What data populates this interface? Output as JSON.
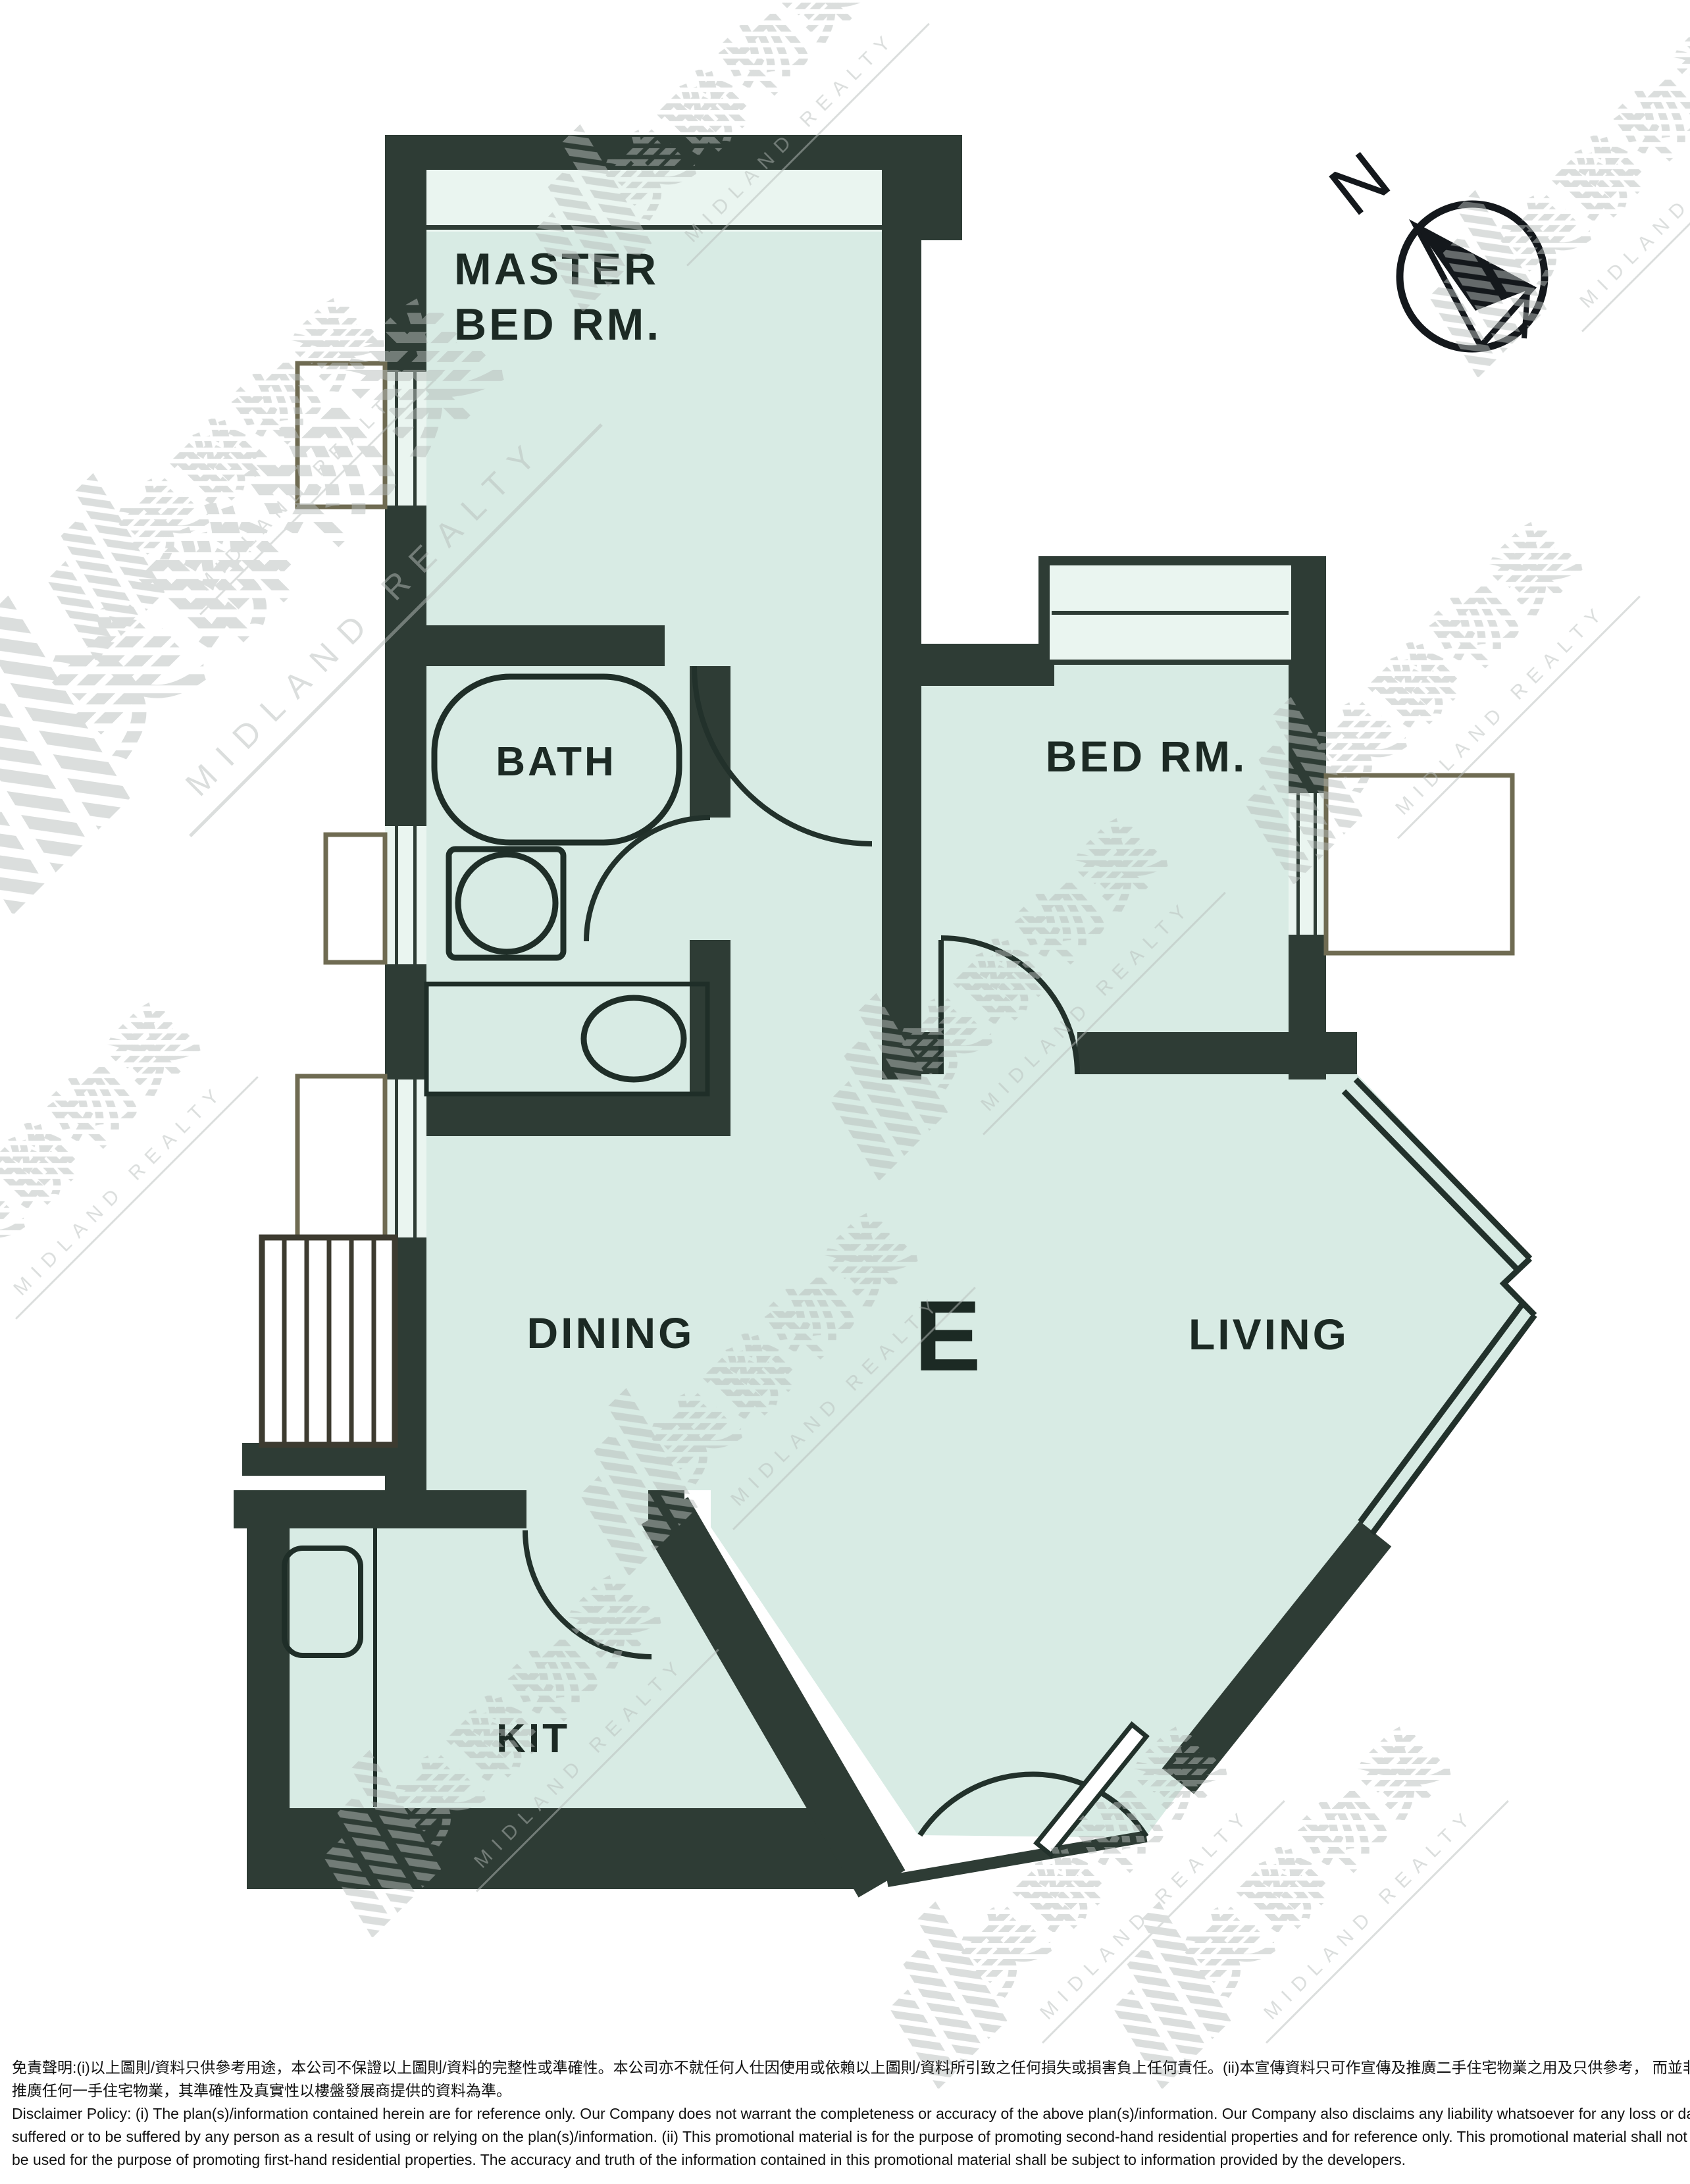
{
  "rooms": {
    "master": {
      "line1": "MASTER",
      "line2": "BED RM."
    },
    "bath": {
      "label": "BATH"
    },
    "bedroom": {
      "label": "BED RM."
    },
    "dining": {
      "label": "DINING"
    },
    "unit": {
      "label": "E"
    },
    "living": {
      "label": "LIVING"
    },
    "kitchen": {
      "label": "KIT"
    }
  },
  "compass": {
    "north": "N"
  },
  "watermark": {
    "cn": "美聯物業",
    "en": "MIDLAND REALTY",
    "color": "#b7bdbb"
  },
  "colors": {
    "room_fill": "#d8ebe4",
    "wall": "#2e3c35",
    "window_fill": "#eaf5f0",
    "line": "#22312b",
    "platform_stroke": "#6f6b52"
  },
  "disclaimer": {
    "zh_line1": "免責聲明:(i)以上圖則/資料只供參考用途，本公司不保證以上圖則/資料的完整性或準確性。本公司亦不就任何人仕因使用或依賴以上圖則/資料所引致之任何損失或損害負上任何責任。(ii)本宣傳資料只可作宣傳及推廣二手住宅物業之用及只供參考， 而並非及不可用作宣傳",
    "zh_line2": "推廣任何一手住宅物業，其準確性及真實性以樓盤發展商提供的資料為準。",
    "en_line1": "Disclaimer Policy: (i) The plan(s)/information contained herein are for reference only. Our Company does not warrant the completeness or accuracy of the above plan(s)/information. Our Company also disclaims any liability whatsoever for any loss or damage",
    "en_line2": "suffered or to be suffered by any person as a result of using or relying on the plan(s)/information. (ii) This promotional material is for the purpose of promoting second-hand residential properties and for reference only. This promotional material shall not",
    "en_line3": "be used for the purpose of promoting first-hand residential properties. The accuracy and truth of the information contained in this promotional material shall be subject to information provided by the developers."
  }
}
